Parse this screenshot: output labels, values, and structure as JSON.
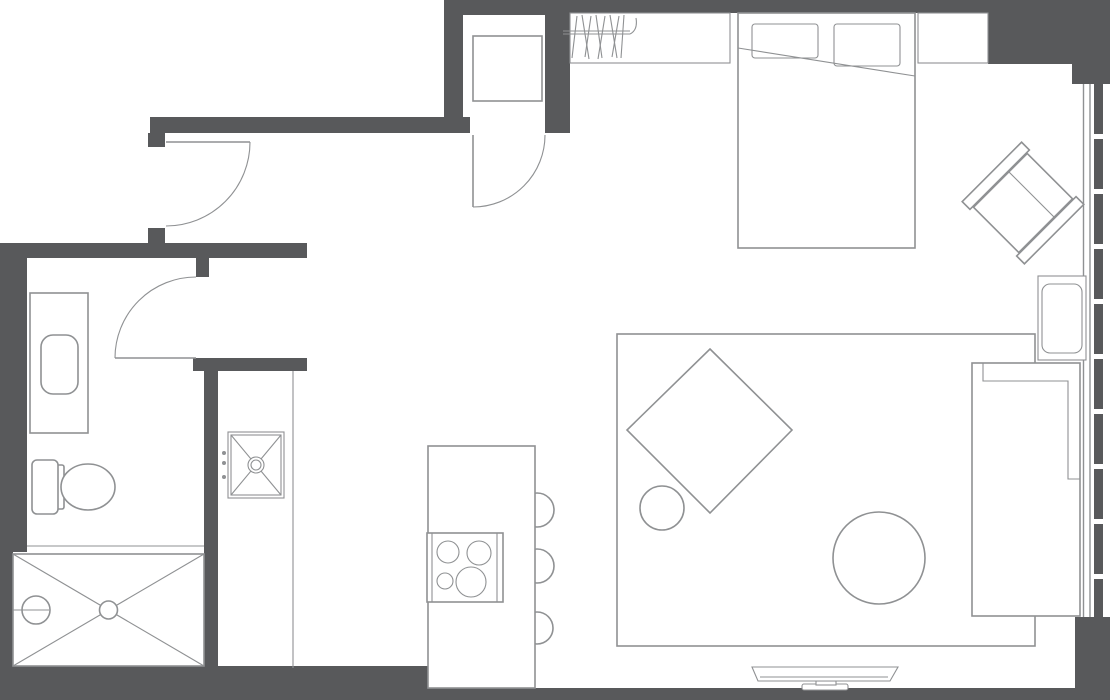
{
  "document": {
    "type": "floor-plan",
    "title": "Studio apartment floor plan",
    "orientation": "top-down architectural drawing",
    "visible_text": "none"
  },
  "colors": {
    "wall": "#58595b",
    "line": "#8f9193",
    "background": "#ffffff",
    "furniture_fill": "#ffffff"
  },
  "rooms": {
    "bathroom": {
      "location": "left",
      "fixtures": [
        "vanity-counter",
        "wash-basin",
        "toilet",
        "shower"
      ],
      "shower_details": [
        "crossed-diagonals",
        "center-drain",
        "shower-head-with-arm"
      ],
      "door": "swing-door-opening-inward"
    },
    "entry": {
      "location": "top-center",
      "fixtures": [
        "entry-cabinet"
      ],
      "door": "entry-swing-door"
    },
    "hallway": {
      "location": "top-left",
      "door": "interior-swing-door"
    },
    "utility": {
      "location": "center-left-column",
      "fixtures": [
        "utility-sink-with-crossed-basin",
        "faucet-drain-ring",
        "three-knob-dots"
      ]
    },
    "kitchen": {
      "location": "center-bottom",
      "island": true,
      "cooktop_burners": 4,
      "bar_stools": 3
    },
    "bedroom": {
      "location": "top-right",
      "bed": true,
      "pillows": 2,
      "blanket_fold_line": true,
      "closet_with_hangers": true,
      "wall_niche": true
    },
    "living": {
      "location": "right",
      "rug": true,
      "diamond_table": true,
      "small_round_table": true,
      "round_coffee_table": true,
      "sofa": true,
      "side_table": true,
      "armchair_rotated_45deg": true,
      "tv_on_stand": true
    },
    "window_wall": {
      "location": "right-edge",
      "style": "double-glass-line-with-segmented-mullion"
    }
  }
}
